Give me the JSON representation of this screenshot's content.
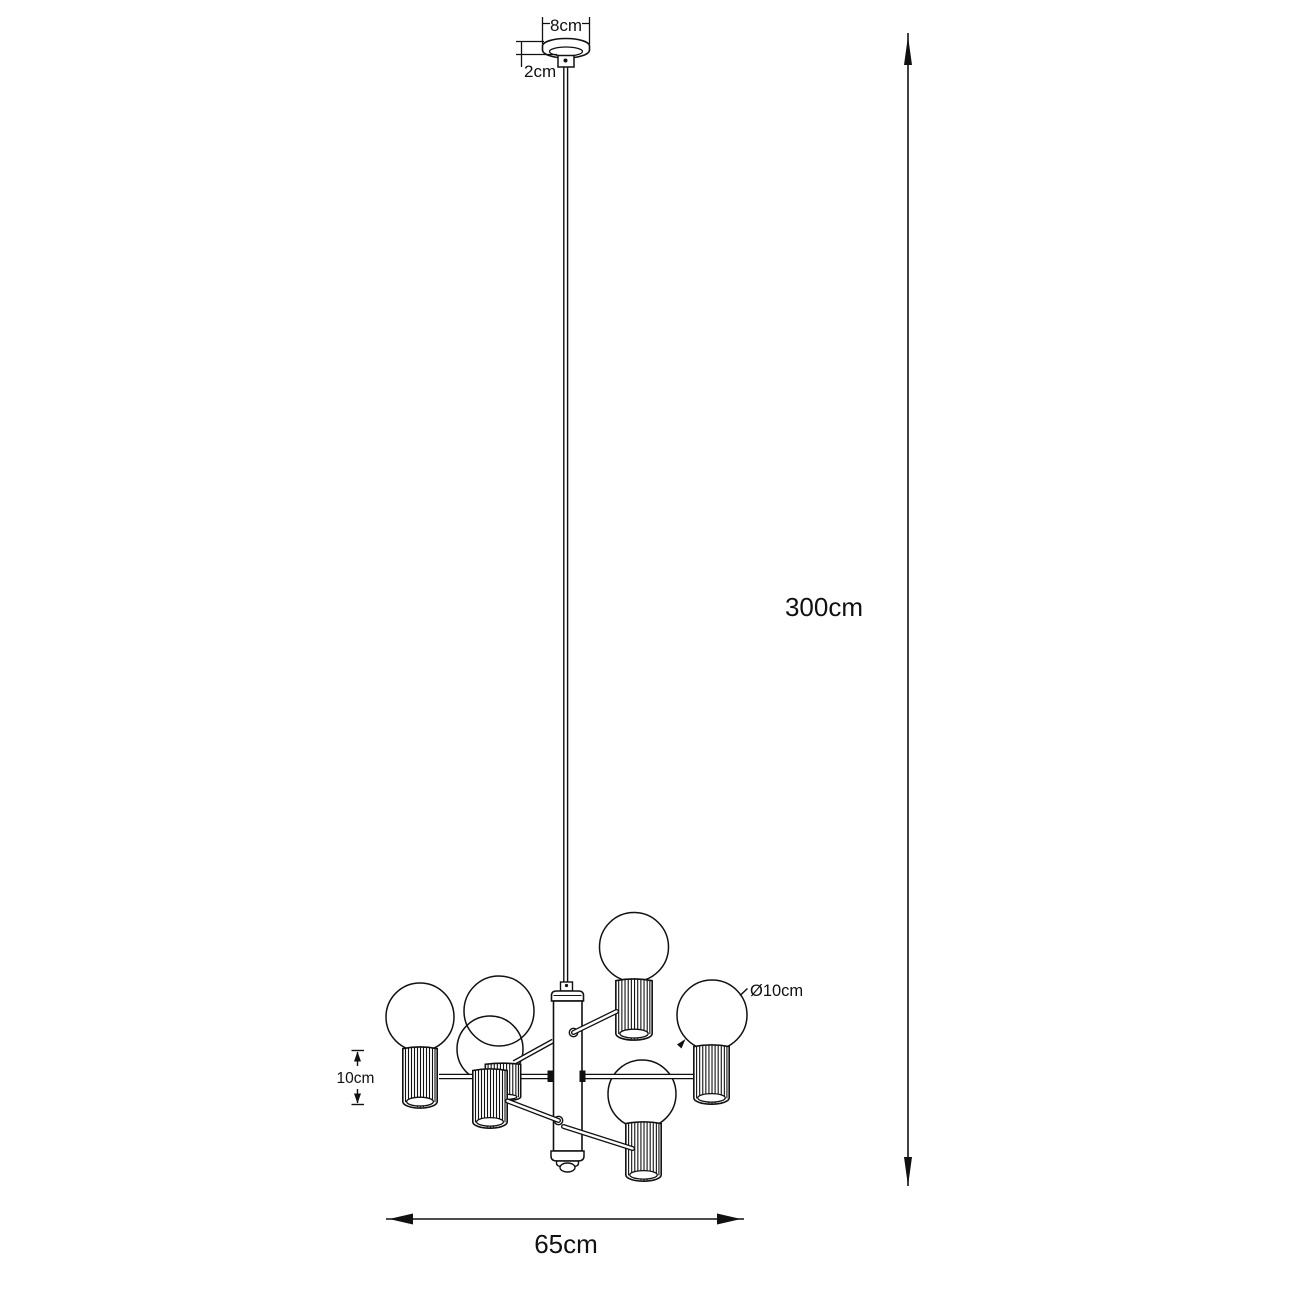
{
  "figure": {
    "kind": "technical dimension drawing",
    "subject": "6-light pendant chandelier with ribbed cylinder shades and globe bulbs",
    "lights_count": 6,
    "line_color": "#111111",
    "background_color": "#ffffff"
  },
  "dimensions": {
    "canopy_width": "8cm",
    "canopy_height": "2cm",
    "suspension_height": "300cm",
    "bulb_diameter": "Ø10cm",
    "shade_height": "10cm",
    "fixture_width": "65cm"
  }
}
